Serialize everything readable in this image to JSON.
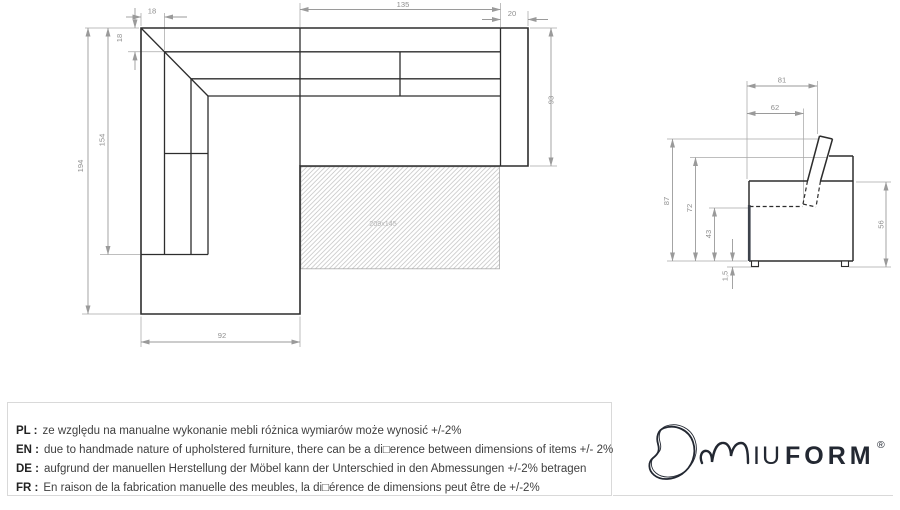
{
  "colors": {
    "drawing_line": "#2d2d2d",
    "dimension_line": "#9a9a9a",
    "dimension_text": "#8f8f8f",
    "hatch_line": "#bdbdbd",
    "frame_border": "#d9d9d9",
    "logo_navy": "#232832"
  },
  "plan_view": {
    "dim_back_thickness_top": "18",
    "dim_seat_width": "135",
    "dim_armrest_width": "20",
    "dim_back_thickness_left": "18",
    "dim_left_section_length": "154",
    "dim_total_length": "194",
    "dim_right_section_depth": "93",
    "dim_chaise_width": "92",
    "sleeping_area_label": "209x145"
  },
  "side_view": {
    "dim_total_depth": "81",
    "dim_seat_depth": "62",
    "dim_total_height": "87",
    "dim_backrest_height": "72",
    "dim_seat_height": "43",
    "dim_leg_height": "1,5",
    "dim_side_height": "56"
  },
  "notes": [
    {
      "label": "PL :",
      "text": "ze względu na manualne wykonanie mebli różnica wymiarów może wynosić +/-2%"
    },
    {
      "label": "EN :",
      "text": "due to handmade nature of upholstered furniture, there can be a di□erence between dimensions of items +/- 2%"
    },
    {
      "label": "DE :",
      "text": "aufgrund der manuellen Herstellung der Möbel kann der Unterschied in den Abmessungen +/-2% betragen"
    },
    {
      "label": "FR :",
      "text": "En raison de la fabrication manuelle des meubles, la di□érence de dimensions peut être de +/-2%"
    }
  ],
  "logo": {
    "letters_iu": "IU",
    "letters_form": "FORM",
    "registered": "®"
  }
}
